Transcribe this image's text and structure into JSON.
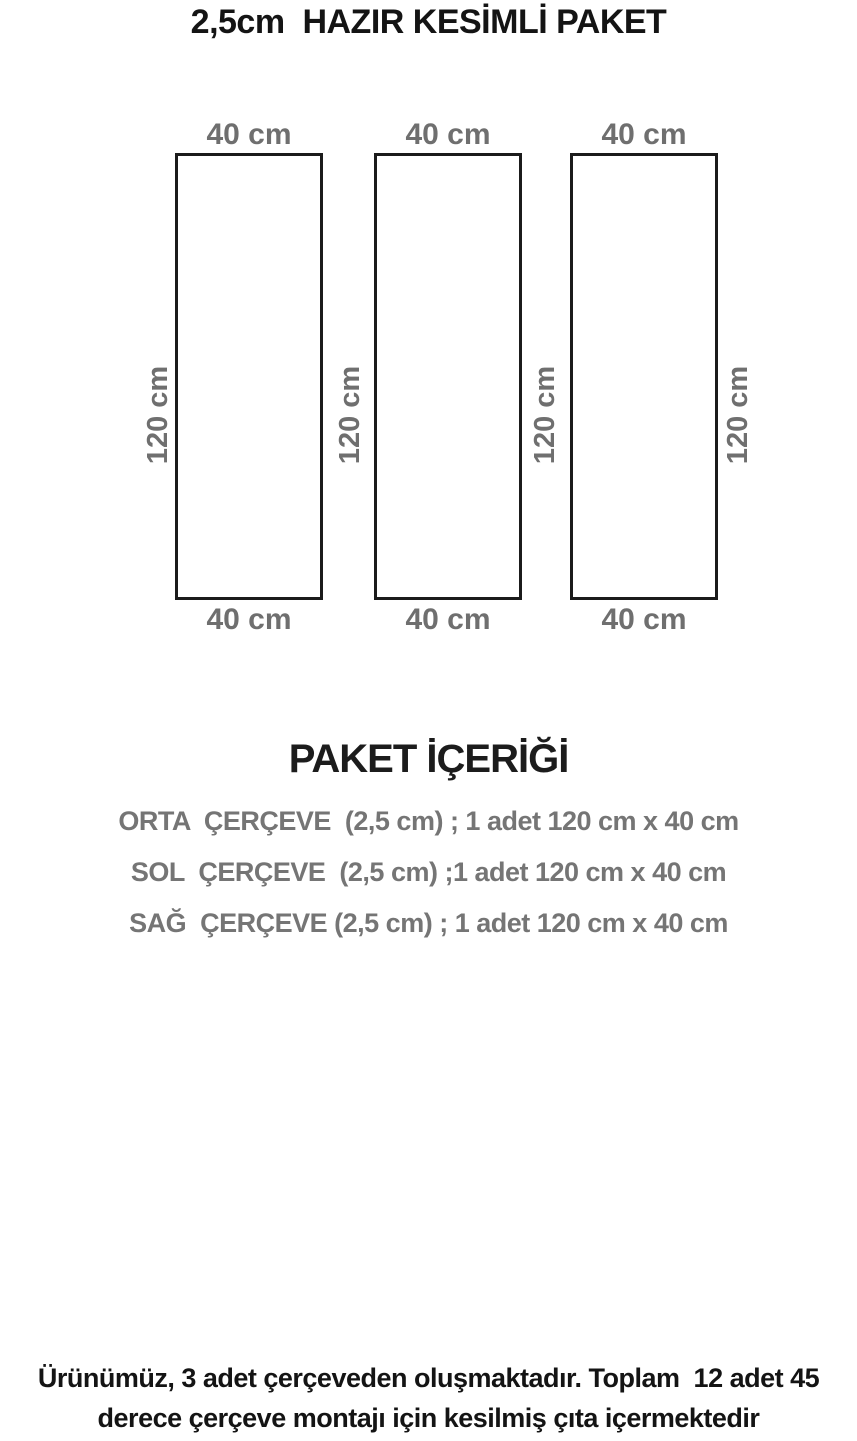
{
  "title": "2,5cm  HAZIR KESİMLİ PAKET",
  "diagram": {
    "panels": [
      {
        "top_label": "40 cm",
        "side_label": "120 cm",
        "bottom_label": "40 cm"
      },
      {
        "top_label": "40 cm",
        "side_label": "120 cm",
        "bottom_label": "40 cm"
      },
      {
        "top_label": "40 cm",
        "side_label": "120 cm",
        "bottom_label": "40 cm"
      }
    ],
    "extra_side_label": "120 cm"
  },
  "package_contents": {
    "heading": "PAKET İÇERİĞİ",
    "items": [
      "ORTA  ÇERÇEVE  (2,5 cm) ; 1 adet 120 cm x 40 cm",
      "SOL  ÇERÇEVE  (2,5 cm) ;1 adet 120 cm x 40 cm",
      "SAĞ  ÇERÇEVE (2,5 cm) ; 1 adet 120 cm x 40 cm"
    ]
  },
  "footer": {
    "line1": "Ürünümüz, 3 adet çerçeveden oluşmaktadır. Toplam  12 adet 45",
    "line2": "derece çerçeve montajı için kesilmiş çıta içermektedir"
  },
  "colors": {
    "label_gray": "#6f6f6f",
    "item_gray": "#757575",
    "ink": "#141414",
    "rect_border": "#1b1b1b"
  }
}
